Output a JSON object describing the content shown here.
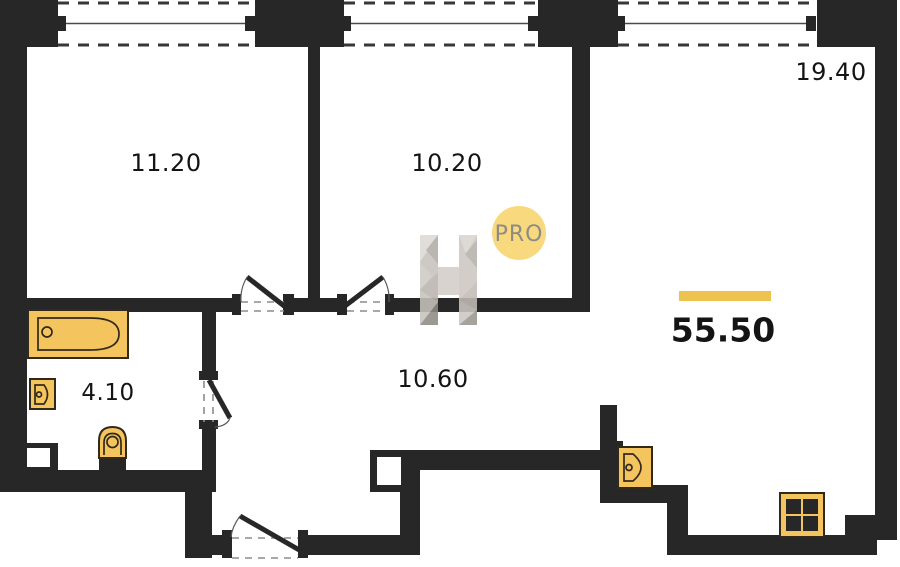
{
  "plan": {
    "rooms": [
      {
        "area": "11.20"
      },
      {
        "area": "10.20"
      },
      {
        "area": "19.40"
      },
      {
        "area": "4.10"
      },
      {
        "area": "10.60"
      }
    ],
    "total_area": "55.50"
  },
  "watermark": {
    "logo_letter": "H",
    "badge": "PRO"
  },
  "colors": {
    "wall": "#272727",
    "fixture_fill": "#f4c45f",
    "fixture_stroke": "#33291a",
    "accent_bar": "#eec24e",
    "watermark_circle": "#f8d97d",
    "watermark_text": "#8e8b85",
    "label_text": "#141414",
    "background": "#ffffff"
  }
}
